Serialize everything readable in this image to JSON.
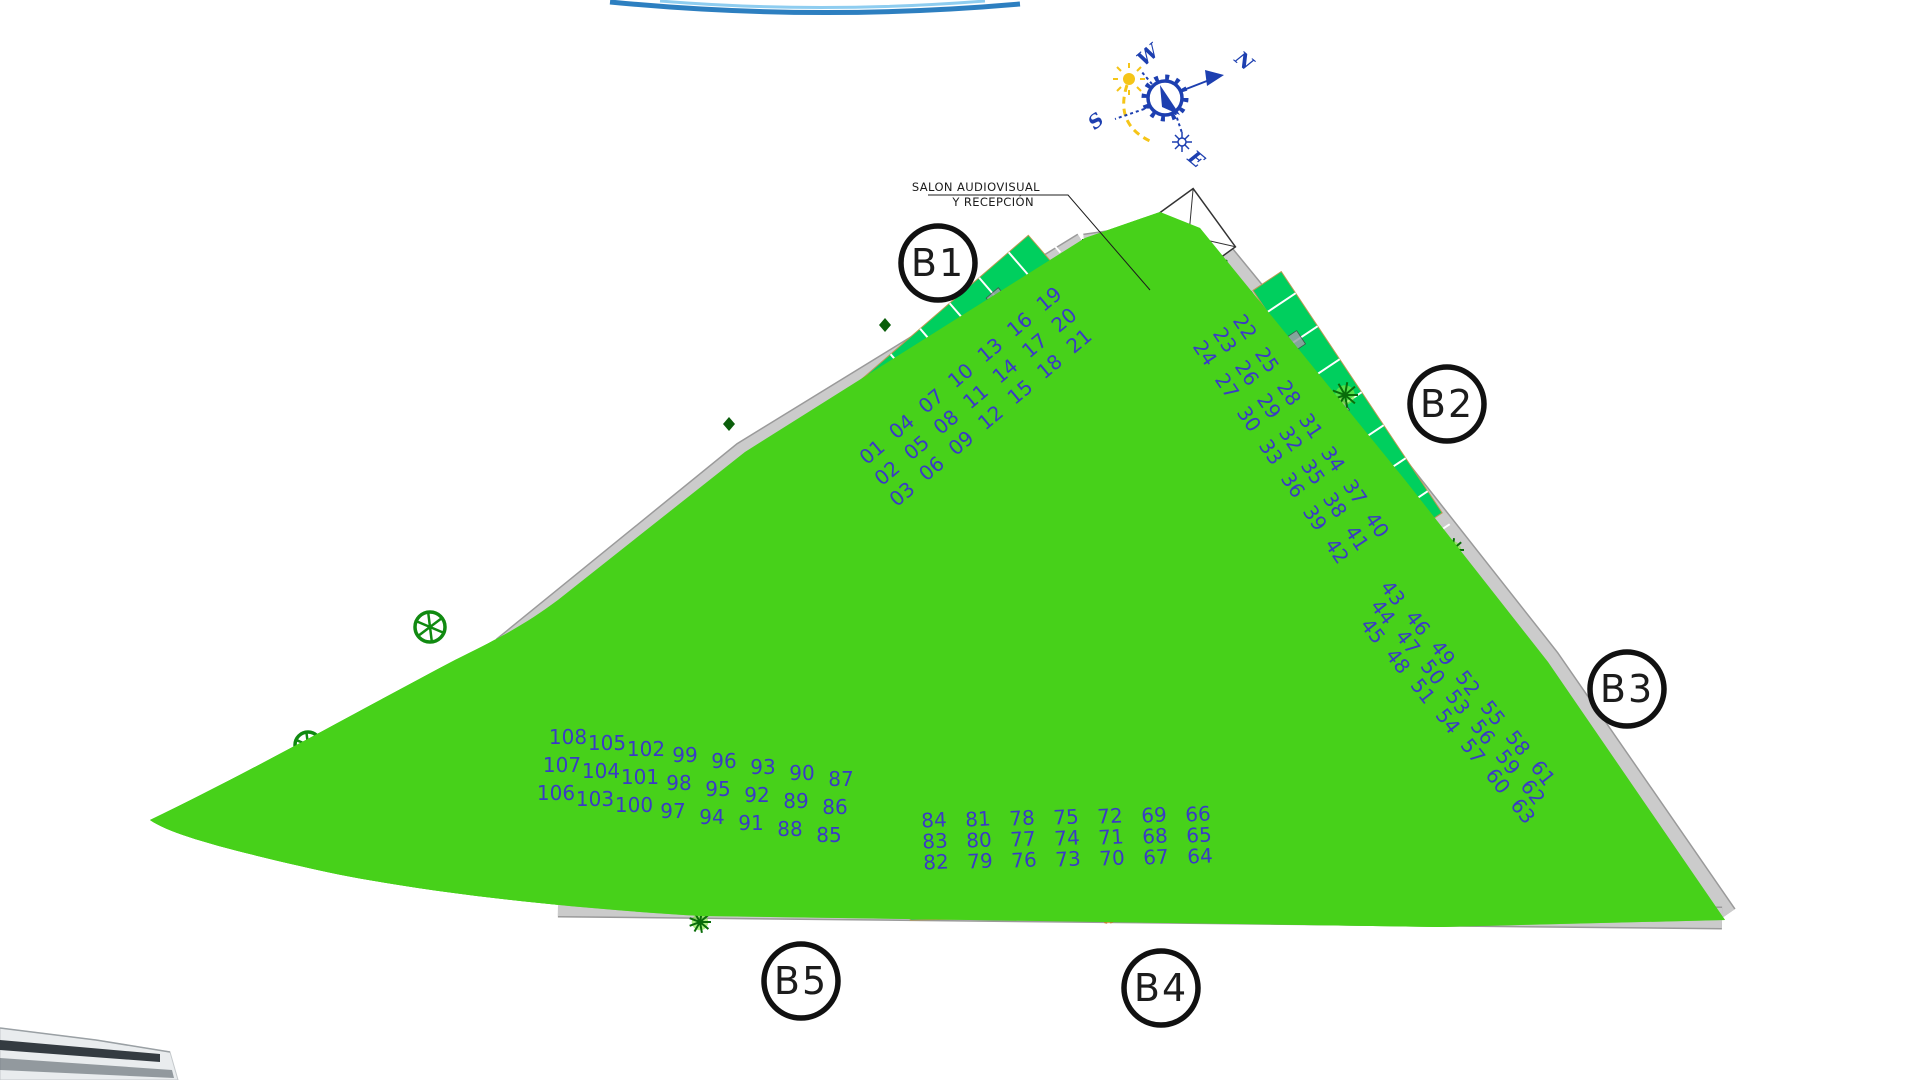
{
  "plan": {
    "colors": {
      "boundary": "#e31ee3",
      "boundaryOuter": "#9b30c9",
      "lawn": "#47d11a",
      "garden": "#00cf5e",
      "road": "#cbcbcb",
      "roadEdge": "#9a9a9a",
      "strip": "#ffffff",
      "poolDeck": "#f3d06e",
      "poolWater": "#7d8ce8",
      "unitNumber": "#3a3ac6",
      "compass": "#1d3fb0",
      "sun": "#f5c518",
      "treeGreen": "#118a11",
      "palmGreen": "#0a6d0a",
      "shrubOrange": "#e89a4e",
      "parasol": "#d6336c"
    }
  },
  "annotation": {
    "line1": "SALON AUDIOVISUAL",
    "line2": "Y RECEPCIÓN"
  },
  "compass": {
    "n": "N",
    "s": "S",
    "e": "E",
    "w": "W"
  },
  "amenities": {
    "petanca": "PETANCA",
    "pingpong": "PING-PONG",
    "gimnasia": "GIMNASIA",
    "children": "CHILDREN GAMES"
  },
  "blocks": [
    {
      "id": "b1",
      "label": "B1",
      "units": [
        "01",
        "02",
        "03",
        "04",
        "05",
        "06",
        "07",
        "08",
        "09",
        "10",
        "11",
        "12",
        "13",
        "14",
        "15",
        "16",
        "17",
        "18",
        "19",
        "20",
        "21"
      ]
    },
    {
      "id": "b2",
      "label": "B2",
      "units": [
        "22",
        "23",
        "24",
        "25",
        "26",
        "27",
        "28",
        "29",
        "30",
        "31",
        "32",
        "33",
        "34",
        "35",
        "36",
        "37",
        "38",
        "39",
        "40",
        "41",
        "42"
      ]
    },
    {
      "id": "b3",
      "label": "B3",
      "units": [
        "43",
        "44",
        "45",
        "46",
        "47",
        "48",
        "49",
        "50",
        "51",
        "52",
        "53",
        "54",
        "55",
        "56",
        "57",
        "58",
        "59",
        "60",
        "61",
        "62",
        "63"
      ]
    },
    {
      "id": "b4",
      "label": "B4",
      "units": [
        "84",
        "83",
        "82",
        "81",
        "80",
        "79",
        "78",
        "77",
        "76",
        "75",
        "74",
        "73",
        "72",
        "71",
        "70",
        "69",
        "68",
        "67",
        "66",
        "65",
        "64"
      ]
    },
    {
      "id": "b5",
      "label": "B5",
      "units": [
        "108",
        "107",
        "106",
        "105",
        "104",
        "103",
        "102",
        "101",
        "100",
        "99",
        "98",
        "97",
        "96",
        "95",
        "94",
        "93",
        "92",
        "91",
        "90",
        "89",
        "88",
        "87",
        "86",
        "85"
      ]
    }
  ]
}
